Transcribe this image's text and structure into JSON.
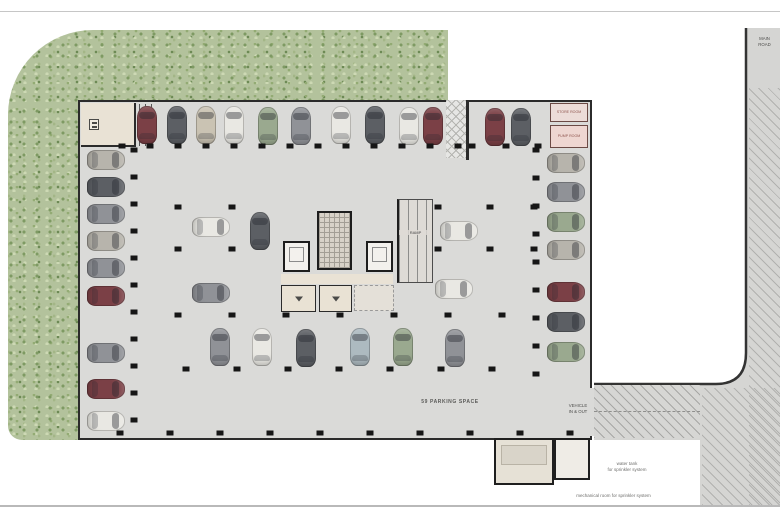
{
  "labels": {
    "parking_count": "59 PARKING SPACE",
    "vehicle_entry_line1": "VEHICLE",
    "vehicle_entry_line2": "IN & OUT",
    "road_line1": "MAIN",
    "road_line2": "ROAD",
    "water_tank_line1": "water tank",
    "water_tank_line2": "for sprinkler system",
    "mech_room": "mechanical room for sprinkler system",
    "store_room": "STORE ROOM",
    "pump_room": "PUMP ROOM",
    "ramp": "RAMP"
  },
  "colors": {
    "landscape_green": "#b3c29c",
    "floor_gray": "#dadad8",
    "wall_dark": "#2b2b2b",
    "road_gray": "#d5d5d3",
    "accent_room_pink": "#ecdcd8",
    "car_palette": {
      "maroon": "#7b4046",
      "dark": "#5c5f64",
      "silver": "#b7b4ac",
      "white": "#e9e8e3",
      "green": "#9aa98f",
      "gray": "#909297",
      "lightblue": "#adbac0",
      "beige": "#cac3b3"
    }
  },
  "cars": [
    {
      "x": 147,
      "y": 125,
      "r": 0,
      "c": "maroon"
    },
    {
      "x": 177,
      "y": 125,
      "r": 0,
      "c": "dark"
    },
    {
      "x": 206,
      "y": 125,
      "r": 0,
      "c": "beige"
    },
    {
      "x": 234,
      "y": 125,
      "r": 0,
      "c": "white"
    },
    {
      "x": 268,
      "y": 126,
      "r": 0,
      "c": "green"
    },
    {
      "x": 301,
      "y": 126,
      "r": 0,
      "c": "gray"
    },
    {
      "x": 341,
      "y": 125,
      "r": 0,
      "c": "white"
    },
    {
      "x": 375,
      "y": 125,
      "r": 0,
      "c": "dark"
    },
    {
      "x": 409,
      "y": 126,
      "r": 0,
      "c": "white"
    },
    {
      "x": 433,
      "y": 126,
      "r": 0,
      "c": "maroon"
    },
    {
      "x": 495,
      "y": 127,
      "r": 0,
      "c": "maroon"
    },
    {
      "x": 521,
      "y": 127,
      "r": 0,
      "c": "dark"
    },
    {
      "x": 106,
      "y": 160,
      "r": 90,
      "c": "silver"
    },
    {
      "x": 106,
      "y": 187,
      "r": 90,
      "c": "dark"
    },
    {
      "x": 106,
      "y": 214,
      "r": 90,
      "c": "gray"
    },
    {
      "x": 106,
      "y": 241,
      "r": 90,
      "c": "silver"
    },
    {
      "x": 106,
      "y": 268,
      "r": 90,
      "c": "gray"
    },
    {
      "x": 106,
      "y": 296,
      "r": 90,
      "c": "maroon"
    },
    {
      "x": 106,
      "y": 353,
      "r": 90,
      "c": "gray"
    },
    {
      "x": 106,
      "y": 389,
      "r": 90,
      "c": "maroon"
    },
    {
      "x": 106,
      "y": 421,
      "r": 90,
      "c": "white"
    },
    {
      "x": 566,
      "y": 163,
      "r": 90,
      "c": "silver"
    },
    {
      "x": 566,
      "y": 192,
      "r": 90,
      "c": "gray"
    },
    {
      "x": 566,
      "y": 222,
      "r": 90,
      "c": "green"
    },
    {
      "x": 566,
      "y": 250,
      "r": 90,
      "c": "silver"
    },
    {
      "x": 566,
      "y": 292,
      "r": 90,
      "c": "maroon"
    },
    {
      "x": 566,
      "y": 322,
      "r": 90,
      "c": "dark"
    },
    {
      "x": 566,
      "y": 352,
      "r": 90,
      "c": "green"
    },
    {
      "x": 211,
      "y": 227,
      "r": 90,
      "c": "white"
    },
    {
      "x": 260,
      "y": 231,
      "r": 0,
      "c": "dark"
    },
    {
      "x": 211,
      "y": 293,
      "r": 90,
      "c": "gray"
    },
    {
      "x": 459,
      "y": 231,
      "r": 90,
      "c": "white"
    },
    {
      "x": 454,
      "y": 289,
      "r": 90,
      "c": "white"
    },
    {
      "x": 220,
      "y": 347,
      "r": 0,
      "c": "gray"
    },
    {
      "x": 262,
      "y": 347,
      "r": 0,
      "c": "white"
    },
    {
      "x": 306,
      "y": 348,
      "r": 0,
      "c": "dark"
    },
    {
      "x": 360,
      "y": 347,
      "r": 0,
      "c": "lightblue"
    },
    {
      "x": 403,
      "y": 347,
      "r": 0,
      "c": "green"
    },
    {
      "x": 455,
      "y": 348,
      "r": 0,
      "c": "gray"
    }
  ]
}
